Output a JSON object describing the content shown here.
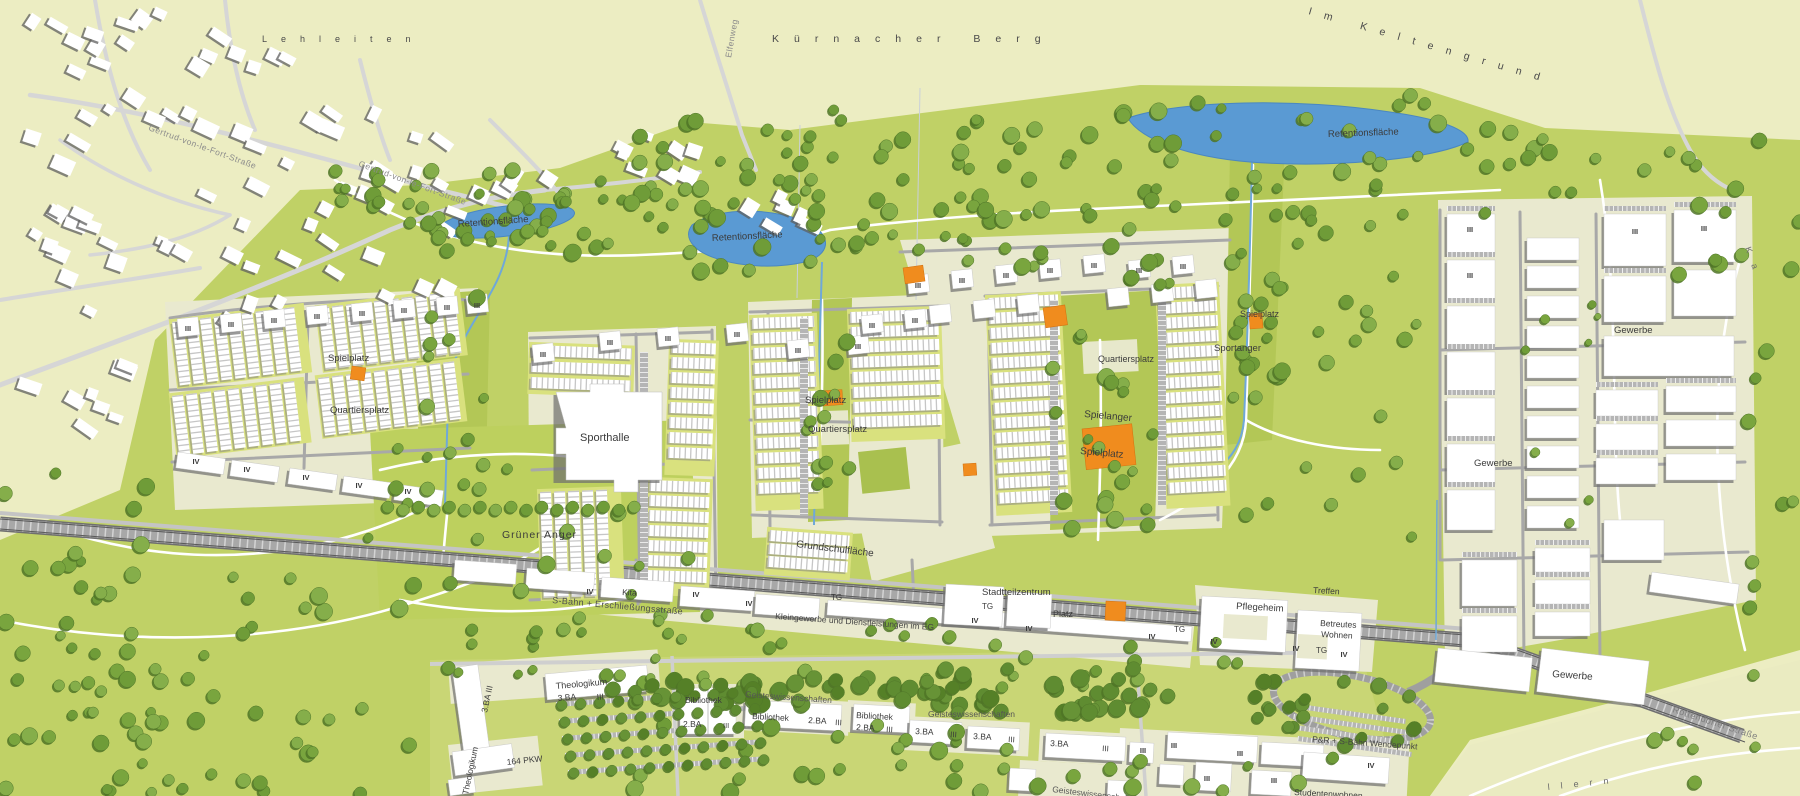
{
  "map": {
    "floor_labels": {
      "three": "III",
      "four": "IV"
    },
    "colors": {
      "field": "#ecedc2",
      "development": "#c0d166",
      "corridor": "#b3c756",
      "anger": "#bdd05e",
      "campus_ground": "#c9d675",
      "plot_cream": "#e9e9cf",
      "plaza_cream": "#e7e8cb",
      "garden": "#d9e17e",
      "water": "#5a9ad3",
      "stream": "#6fa8d8",
      "play_orange": "#f08c1e",
      "railway": "#a8a8a8",
      "building": "#ffffff",
      "building_shadow": "#6d6d6d",
      "street_gray": "#a8a8a8",
      "village_street": "#d6d6d6",
      "pale_corner": "#eaebc1",
      "label_dark": "#3b3b3b",
      "label_gray": "#8b8b8b"
    },
    "labels": [
      {
        "id": "field-lehleiten",
        "text": "Lehleiten",
        "x": 262,
        "y": 42,
        "rot": 0,
        "size": 9,
        "ls": 14,
        "color": "#4a4a4a"
      },
      {
        "id": "field-kuernacher-berg",
        "text": "Kürnacher Berg",
        "x": 772,
        "y": 42,
        "rot": 0,
        "size": 10.5,
        "ls": 15,
        "color": "#4a4a4a"
      },
      {
        "id": "field-im-keltengrund",
        "text": "Im Keltengrund",
        "x": 1308,
        "y": 14,
        "rot": 16,
        "size": 10.5,
        "ls": 13,
        "color": "#4a4a4a"
      },
      {
        "id": "field-east",
        "text": "Ka",
        "x": 1745,
        "y": 248,
        "rot": 70,
        "size": 9,
        "ls": 12,
        "color": "#6b6b6b"
      },
      {
        "id": "field-south",
        "text": "llern",
        "x": 1548,
        "y": 790,
        "rot": -6,
        "size": 9,
        "ls": 11,
        "color": "#6b6b6b"
      },
      {
        "id": "street-gertrud-1",
        "text": "Gertrud-von-le-Fort-Straße",
        "x": 148,
        "y": 130,
        "rot": 20,
        "size": 8.5,
        "ls": 0.5,
        "color": "#8b8b8b"
      },
      {
        "id": "street-gertrud-2",
        "text": "Gertrud-von-le-Fort-Straße",
        "x": 358,
        "y": 166,
        "rot": 20,
        "size": 8.5,
        "ls": 0.5,
        "color": "#8b8b8b"
      },
      {
        "id": "street-elfenweg",
        "text": "Elfenweg",
        "x": 731,
        "y": 58,
        "rot": -80,
        "size": 8.5,
        "ls": 0.5,
        "color": "#8b8b8b"
      },
      {
        "id": "street-rottendorfer",
        "text": "Rottendorfer Straße",
        "x": 1672,
        "y": 712,
        "rot": 18,
        "size": 9,
        "ls": 0.5,
        "color": "#7e7e7e"
      },
      {
        "id": "road-sbahn",
        "text": "S-Bahn + Erschließungsstraße",
        "x": 552,
        "y": 603,
        "rot": 5,
        "size": 9,
        "ls": 0.3,
        "color": "#4f4f4f"
      },
      {
        "id": "retention-west",
        "text": "Retentionsfläche",
        "x": 458,
        "y": 227,
        "rot": -4,
        "size": 9.5,
        "color": "#3b3b3b"
      },
      {
        "id": "retention-mid",
        "text": "Retentionsfläche",
        "x": 712,
        "y": 241,
        "rot": -3,
        "size": 9.5,
        "color": "#3b3b3b"
      },
      {
        "id": "retention-east",
        "text": "Retentionsfläche",
        "x": 1328,
        "y": 137,
        "rot": -2,
        "size": 9.5,
        "color": "#3b3b3b"
      },
      {
        "id": "spielplatz-west",
        "text": "Spielplatz",
        "x": 328,
        "y": 361,
        "rot": 0,
        "size": 9.5,
        "color": "#3b3b3b"
      },
      {
        "id": "quartiersplatz-west",
        "text": "Quartiersplatz",
        "x": 330,
        "y": 413,
        "rot": 0,
        "size": 9.5,
        "color": "#3b3b3b"
      },
      {
        "id": "sporthalle",
        "text": "Sporthalle",
        "x": 580,
        "y": 441,
        "rot": 0,
        "size": 11,
        "color": "#3b3b3b"
      },
      {
        "id": "gruener-anger",
        "text": "Grüner Anger",
        "x": 502,
        "y": 538,
        "rot": 0,
        "size": 10.5,
        "ls": 1,
        "color": "#3b3b3b"
      },
      {
        "id": "spielplatz-mitte",
        "text": "Spielplatz",
        "x": 805,
        "y": 403,
        "rot": 0,
        "size": 9.5,
        "color": "#3b3b3b"
      },
      {
        "id": "quartiersplatz-mitte",
        "text": "Quartiersplatz",
        "x": 808,
        "y": 432,
        "rot": 0,
        "size": 9.5,
        "color": "#3b3b3b"
      },
      {
        "id": "grundschulflaeche",
        "text": "Grundschulfläche",
        "x": 796,
        "y": 547,
        "rot": 7,
        "size": 10,
        "color": "#3b3b3b"
      },
      {
        "id": "spielanger",
        "text": "Spielanger",
        "x": 1084,
        "y": 417,
        "rot": 5,
        "size": 10,
        "color": "#3b3b3b"
      },
      {
        "id": "spielplatz-ost",
        "text": "Spielplatz",
        "x": 1080,
        "y": 454,
        "rot": 5,
        "size": 10,
        "color": "#3b3b3b"
      },
      {
        "id": "spielplatz-nordost",
        "text": "Spielplatz",
        "x": 1240,
        "y": 317,
        "rot": 0,
        "size": 9,
        "color": "#3b3b3b"
      },
      {
        "id": "quartiersplatz-ost",
        "text": "Quartiersplatz",
        "x": 1098,
        "y": 362,
        "rot": 0,
        "size": 9,
        "color": "#3b3b3b"
      },
      {
        "id": "sportanger",
        "text": "Sportanger",
        "x": 1214,
        "y": 351,
        "rot": 0,
        "size": 9.5,
        "color": "#3b3b3b"
      },
      {
        "id": "stadtteilzentrum",
        "text": "Stadtteilzentrum",
        "x": 982,
        "y": 595,
        "rot": 0,
        "size": 9.5,
        "color": "#3b3b3b"
      },
      {
        "id": "tg-stadtteilzentrum",
        "text": "TG",
        "x": 982,
        "y": 609,
        "rot": 0,
        "size": 8,
        "color": "#3b3b3b"
      },
      {
        "id": "platz",
        "text": "Platz",
        "x": 1053,
        "y": 617,
        "rot": 0,
        "size": 9,
        "color": "#3b3b3b"
      },
      {
        "id": "tg-mitte",
        "text": "TG",
        "x": 1174,
        "y": 632,
        "rot": 0,
        "size": 8,
        "color": "#3b3b3b"
      },
      {
        "id": "tg-kleingewerbe",
        "text": "TG",
        "x": 831,
        "y": 600,
        "rot": 0,
        "size": 8,
        "color": "#3b3b3b"
      },
      {
        "id": "pflegeheim",
        "text": "Pflegeheim",
        "x": 1236,
        "y": 609,
        "rot": 3,
        "size": 9.5,
        "color": "#3b3b3b"
      },
      {
        "id": "treffen",
        "text": "Treffen",
        "x": 1313,
        "y": 593,
        "rot": 3,
        "size": 8.5,
        "color": "#3b3b3b"
      },
      {
        "id": "betreutes",
        "text": "Betreutes",
        "x": 1320,
        "y": 626,
        "rot": 3,
        "size": 8.5,
        "color": "#3b3b3b"
      },
      {
        "id": "wohnen",
        "text": "Wohnen",
        "x": 1321,
        "y": 637,
        "rot": 3,
        "size": 8.5,
        "color": "#3b3b3b"
      },
      {
        "id": "tg-betreutes",
        "text": "TG",
        "x": 1316,
        "y": 653,
        "rot": 0,
        "size": 8,
        "color": "#3b3b3b"
      },
      {
        "id": "kita",
        "text": "Kita",
        "x": 622,
        "y": 595,
        "rot": 3,
        "size": 8.5,
        "color": "#3b3b3b"
      },
      {
        "id": "kleingewerbe",
        "text": "Kleingewerbe und Dienstleistungen im EG",
        "x": 775,
        "y": 619,
        "rot": 4,
        "size": 8.5,
        "color": "#454545"
      },
      {
        "id": "gewerbe-nord",
        "text": "Gewerbe",
        "x": 1614,
        "y": 333,
        "rot": 0,
        "size": 9.5,
        "color": "#3b3b3b"
      },
      {
        "id": "gewerbe-mitte",
        "text": "Gewerbe",
        "x": 1474,
        "y": 466,
        "rot": 0,
        "size": 9.5,
        "color": "#3b3b3b"
      },
      {
        "id": "gewerbe-sued",
        "text": "Gewerbe",
        "x": 1552,
        "y": 677,
        "rot": 4,
        "size": 10,
        "color": "#3b3b3b"
      },
      {
        "id": "theologikum",
        "text": "Theologikum",
        "x": 556,
        "y": 689,
        "rot": -5,
        "size": 9,
        "color": "#3b3b3b"
      },
      {
        "id": "theologikum-ba",
        "text": "3.BA",
        "x": 558,
        "y": 701,
        "rot": -5,
        "size": 8.5,
        "color": "#3b3b3b"
      },
      {
        "id": "theologikum-floors",
        "text": "III",
        "x": 597,
        "y": 700,
        "rot": -5,
        "size": 8.5,
        "color": "#3b3b3b"
      },
      {
        "id": "theologikum-vert",
        "text": "Theologikum",
        "x": 468,
        "y": 795,
        "rot": -78,
        "size": 8.5,
        "color": "#3b3b3b"
      },
      {
        "id": "ba-vert",
        "text": "3.BA III",
        "x": 487,
        "y": 713,
        "rot": -78,
        "size": 8.5,
        "color": "#3b3b3b"
      },
      {
        "id": "pkw",
        "text": "164 PKW",
        "x": 507,
        "y": 765,
        "rot": -6,
        "size": 8.5,
        "color": "#3b3b3b"
      },
      {
        "id": "bibliothek-1",
        "text": "Bibliothek",
        "x": 685,
        "y": 703,
        "rot": 0,
        "size": 8.5,
        "color": "#3b3b3b"
      },
      {
        "id": "bibliothek-1-ba",
        "text": "2.BA",
        "x": 683,
        "y": 727,
        "rot": 0,
        "size": 8.5,
        "color": "#3b3b3b"
      },
      {
        "id": "bibliothek-1-floors",
        "text": "III",
        "x": 723,
        "y": 728,
        "rot": 0,
        "size": 7.5,
        "color": "#3b3b3b"
      },
      {
        "id": "geisteswissenschaften-1",
        "text": "Geisteswissenschaften",
        "x": 745,
        "y": 697,
        "rot": 4,
        "size": 8.5,
        "color": "#555555"
      },
      {
        "id": "bibliothek-2",
        "text": "Bibliothek",
        "x": 752,
        "y": 719,
        "rot": 3,
        "size": 8.5,
        "color": "#3b3b3b"
      },
      {
        "id": "bibliothek-2-ba",
        "text": "2.BA",
        "x": 808,
        "y": 723,
        "rot": 3,
        "size": 8.5,
        "color": "#3b3b3b"
      },
      {
        "id": "bibliothek-2-floors",
        "text": "III",
        "x": 835,
        "y": 725,
        "rot": 3,
        "size": 8,
        "color": "#3b3b3b"
      },
      {
        "id": "bibliothek-3",
        "text": "Bibliothek",
        "x": 856,
        "y": 718,
        "rot": 3,
        "size": 8.5,
        "color": "#3b3b3b"
      },
      {
        "id": "bibliothek-3-ba",
        "text": "2.BA",
        "x": 856,
        "y": 730,
        "rot": 3,
        "size": 8.5,
        "color": "#3b3b3b"
      },
      {
        "id": "bibliothek-3-floors",
        "text": "III",
        "x": 886,
        "y": 732,
        "rot": 3,
        "size": 8,
        "color": "#3b3b3b"
      },
      {
        "id": "geisteswissenschaften-2",
        "text": "Geisteswissenschaften",
        "x": 928,
        "y": 717,
        "rot": 0,
        "size": 8.5,
        "color": "#555555"
      },
      {
        "id": "ba-row-1",
        "text": "3.BA",
        "x": 915,
        "y": 734,
        "rot": 3,
        "size": 8.5,
        "color": "#3b3b3b"
      },
      {
        "id": "ba-row-1-floors",
        "text": "III",
        "x": 950,
        "y": 737,
        "rot": 3,
        "size": 8,
        "color": "#3b3b3b"
      },
      {
        "id": "ba-row-2",
        "text": "3.BA",
        "x": 973,
        "y": 739,
        "rot": 3,
        "size": 8.5,
        "color": "#3b3b3b"
      },
      {
        "id": "ba-row-2-floors",
        "text": "III",
        "x": 1008,
        "y": 742,
        "rot": 3,
        "size": 8,
        "color": "#3b3b3b"
      },
      {
        "id": "ba-row-3",
        "text": "3.BA",
        "x": 1050,
        "y": 746,
        "rot": 3,
        "size": 8.5,
        "color": "#3b3b3b"
      },
      {
        "id": "ba-row-3-floors",
        "text": "III",
        "x": 1102,
        "y": 751,
        "rot": 3,
        "size": 8,
        "color": "#3b3b3b"
      },
      {
        "id": "geisteswissenschaften-3",
        "text": "Geisteswissenschaften",
        "x": 1052,
        "y": 792,
        "rot": 7,
        "size": 8.5,
        "color": "#555555"
      },
      {
        "id": "pr-wendepunkt",
        "text": "P&R + S-Bahn Wendepunkt",
        "x": 1312,
        "y": 742,
        "rot": 4,
        "size": 8.5,
        "color": "#454545"
      },
      {
        "id": "studentenwohnen",
        "text": "Studentenwohnen",
        "x": 1294,
        "y": 795,
        "rot": 3,
        "size": 8.5,
        "color": "#3b3b3b"
      }
    ]
  }
}
